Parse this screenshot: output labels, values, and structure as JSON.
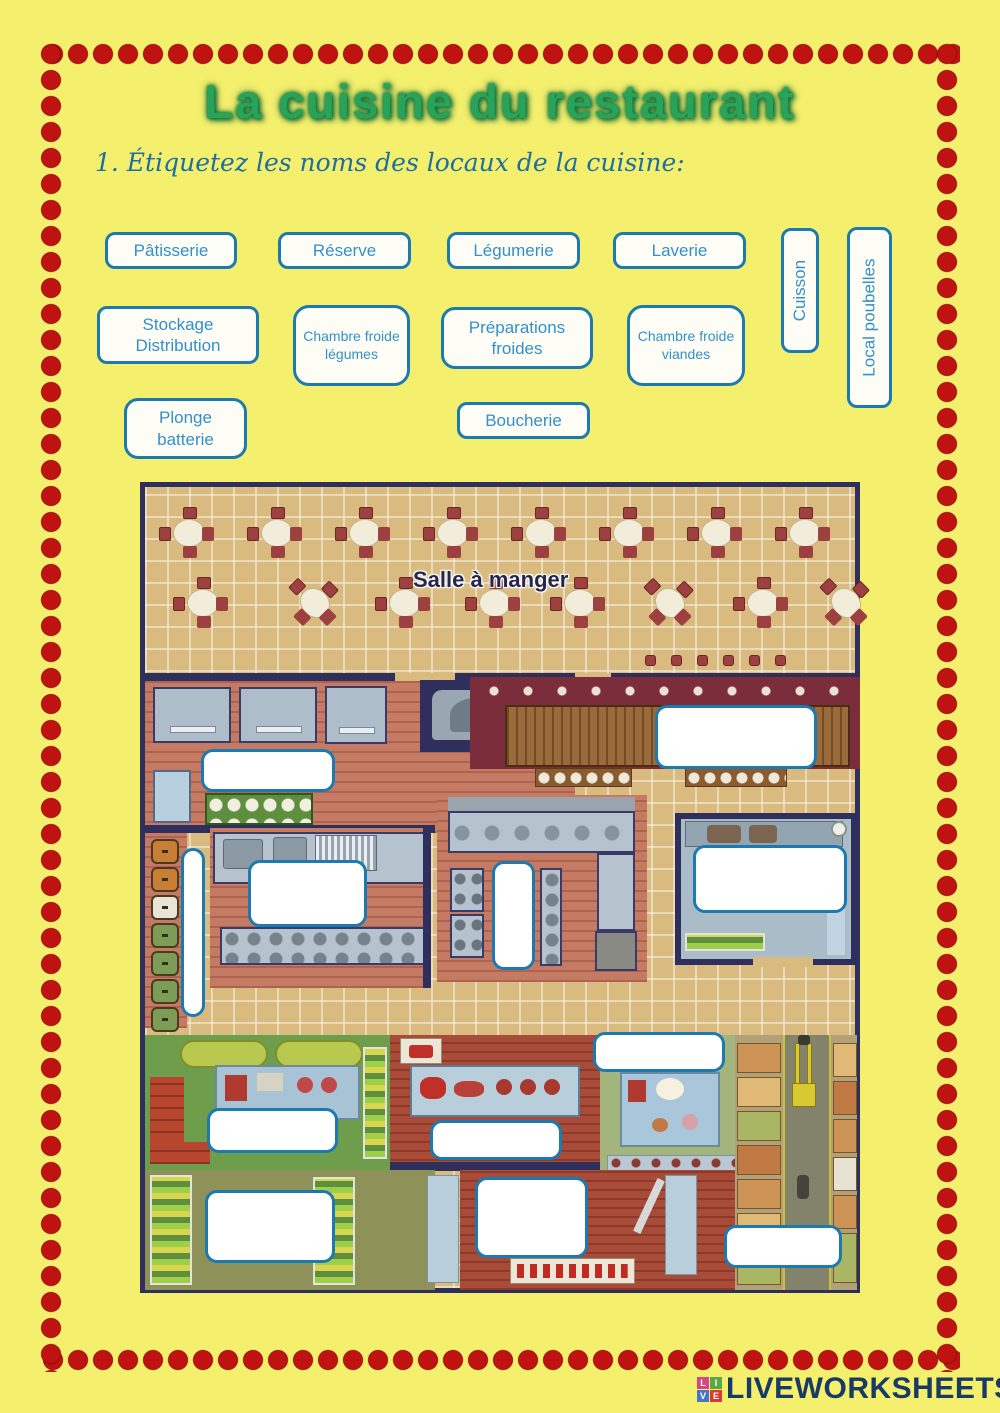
{
  "page": {
    "title": "La cuisine du restaurant",
    "instruction": "1. Étiquetez les noms des locaux de la cuisine:",
    "colors": {
      "background": "#f4ef6d",
      "apple_border": "#c11212",
      "title_green": "#27a35a",
      "label_blue": "#3390cc",
      "box_border_blue": "#1d7ab0",
      "plan_wall_navy": "#2f2f5d"
    }
  },
  "word_bank": [
    {
      "label": "Pâtisserie"
    },
    {
      "label": "Réserve"
    },
    {
      "label": "Légumerie"
    },
    {
      "label": "Laverie"
    },
    {
      "label": "Stockage Distribution"
    },
    {
      "label": "Chambre froide légumes"
    },
    {
      "label": "Préparations froides"
    },
    {
      "label": "Chambre froide viandes"
    },
    {
      "label": "Plonge batterie"
    },
    {
      "label": "Boucherie"
    },
    {
      "label": "Cuisson"
    },
    {
      "label": "Local poubelles"
    }
  ],
  "floor_plan": {
    "dining_room_label": "Salle à manger"
  },
  "footer": {
    "brand": "LIVEWORKSHEETS",
    "logo_letters": [
      "L",
      "I",
      "V",
      "E"
    ]
  }
}
